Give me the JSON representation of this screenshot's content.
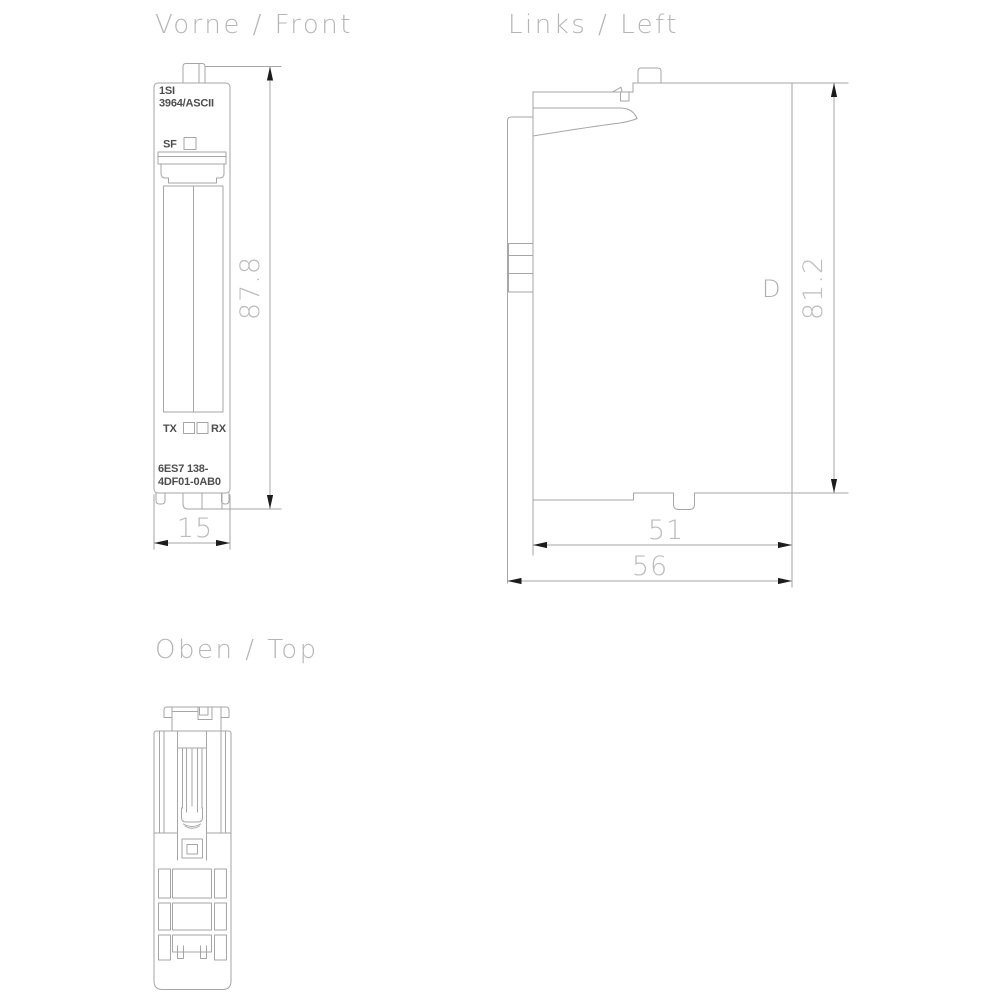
{
  "titles": {
    "front": "Vorne / Front",
    "left": "Links / Left",
    "top": "Oben / Top"
  },
  "front_view": {
    "module_label_line1": "1SI",
    "module_label_line2": "3964/ASCII",
    "sf_led_label": "SF",
    "tx_led_label": "TX",
    "rx_led_label": "RX",
    "order_number_line1": "6ES7 138-",
    "order_number_line2": "4DF01-0AB0",
    "height_dim": "87.8",
    "width_dim": "15"
  },
  "left_view": {
    "height_dim": "81.2",
    "depth_dim_inner": "51",
    "depth_dim_outer": "56",
    "marking": "D"
  },
  "colors": {
    "background": "#ffffff",
    "drawing_line": "#a6a6a6",
    "dimension_text": "#bcbcbc",
    "title_text": "#b5b5b5",
    "module_label_text": "#4e4e4e",
    "arrow": "#1d1d1d"
  }
}
